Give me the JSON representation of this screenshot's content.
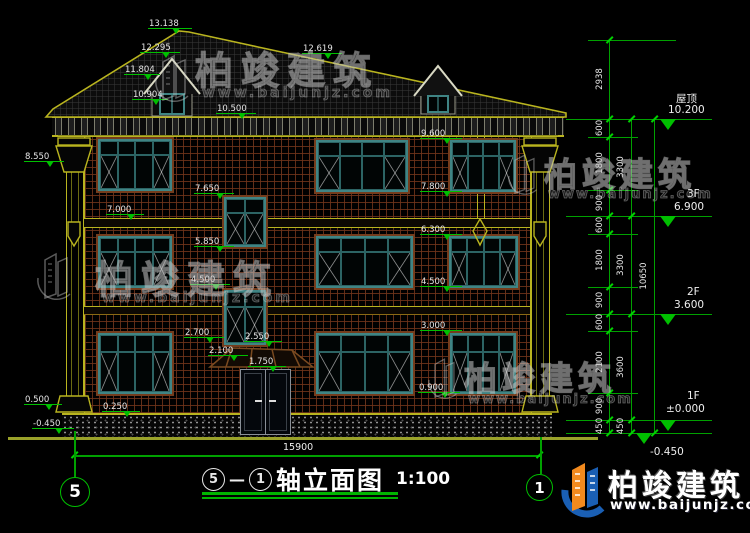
{
  "drawing": {
    "title": {
      "axis_start": "5",
      "axis_end": "1",
      "name": "轴立面图",
      "scale": "1:100"
    },
    "overall_width_dim": "15900",
    "watermark": {
      "name": "柏竣建筑",
      "url": "www.baijunjz.com"
    },
    "facade_levels": [
      {
        "v": "13.138"
      },
      {
        "v": "12.295"
      },
      {
        "v": "11.804"
      },
      {
        "v": "10.904"
      },
      {
        "v": "12.619"
      },
      {
        "v": "10.500"
      },
      {
        "v": "9.600"
      },
      {
        "v": "8.550"
      },
      {
        "v": "7.800"
      },
      {
        "v": "7.650"
      },
      {
        "v": "7.000"
      },
      {
        "v": "6.300"
      },
      {
        "v": "5.850"
      },
      {
        "v": "4.500"
      },
      {
        "v": "4.500"
      },
      {
        "v": "3.000"
      },
      {
        "v": "2.700"
      },
      {
        "v": "2.550"
      },
      {
        "v": "2.100"
      },
      {
        "v": "1.750"
      },
      {
        "v": "0.900"
      },
      {
        "v": "0.500"
      },
      {
        "v": "0.250"
      },
      {
        "v": "-0.450"
      }
    ],
    "right_levels": [
      {
        "name": "屋顶",
        "v": "10.200"
      },
      {
        "name": "3F",
        "v": "6.900"
      },
      {
        "name": "2F",
        "v": "3.600"
      },
      {
        "name": "1F",
        "v": "±0.000"
      },
      {
        "name": "",
        "v": "-0.450"
      }
    ],
    "chains": {
      "inner": [
        "2938",
        "600",
        "1800",
        "900",
        "600",
        "1800",
        "900",
        "600",
        "2100",
        "900",
        "450"
      ],
      "mid": [
        "3300",
        "3300",
        "3600",
        "450"
      ],
      "outer": [
        "10650"
      ]
    }
  }
}
